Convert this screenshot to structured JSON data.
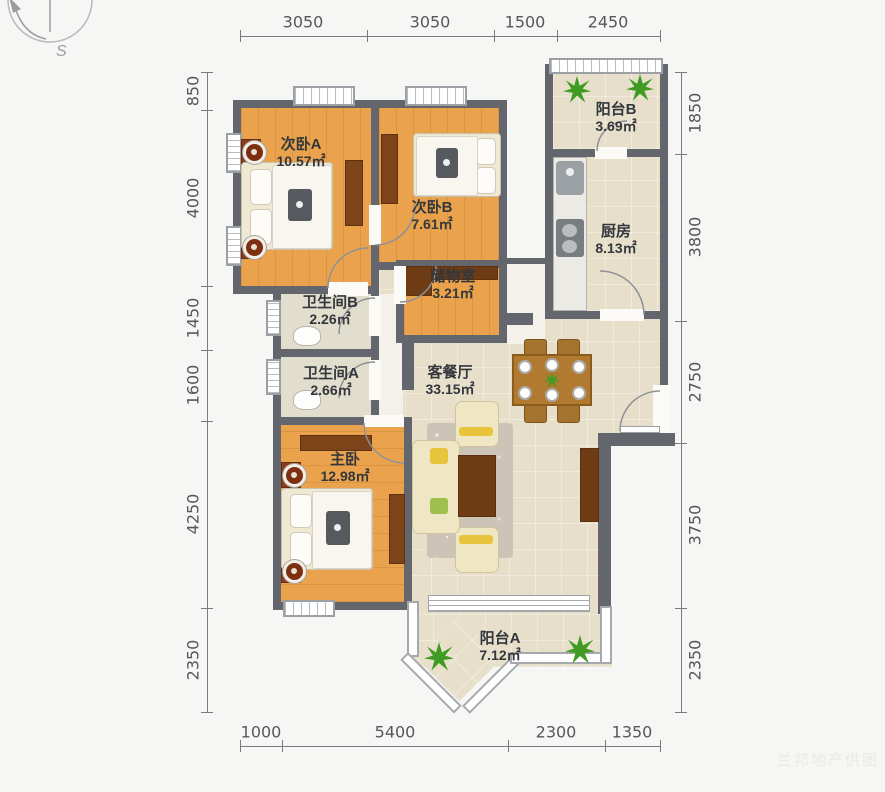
{
  "compass": {
    "label": "S"
  },
  "rooms": {
    "bedroom_a": {
      "name": "次卧A",
      "area": "10.57㎡"
    },
    "bedroom_b": {
      "name": "次卧B",
      "area": "7.61㎡"
    },
    "balcony_b": {
      "name": "阳台B",
      "area": "3.69㎡"
    },
    "kitchen": {
      "name": "厨房",
      "area": "8.13㎡"
    },
    "storage": {
      "name": "储物室",
      "area": "3.21㎡"
    },
    "bath_b": {
      "name": "卫生间B",
      "area": "2.26㎡"
    },
    "bath_a": {
      "name": "卫生间A",
      "area": "2.66㎡"
    },
    "living": {
      "name": "客餐厅",
      "area": "33.15㎡"
    },
    "master": {
      "name": "主卧",
      "area": "12.98㎡"
    },
    "balcony_a": {
      "name": "阳台A",
      "area": "7.12㎡"
    }
  },
  "dimensions": {
    "top": [
      "3050",
      "3050",
      "1500",
      "2450"
    ],
    "bottom": [
      "1000",
      "5400",
      "2300",
      "1350"
    ],
    "left": [
      "850",
      "4000",
      "1450",
      "1600",
      "4250",
      "2350"
    ],
    "right": [
      "1850",
      "3800",
      "2750",
      "3750",
      "2350"
    ]
  },
  "watermark": "兰邦地产供图",
  "colors": {
    "wall": "#63666c",
    "wood": "#eaa24c",
    "tile": "#e7dfca",
    "bath": "#e1decd",
    "brown": "#7c4418",
    "green": "#3f9b22",
    "label": "#33373c",
    "dim": "#55585b"
  }
}
